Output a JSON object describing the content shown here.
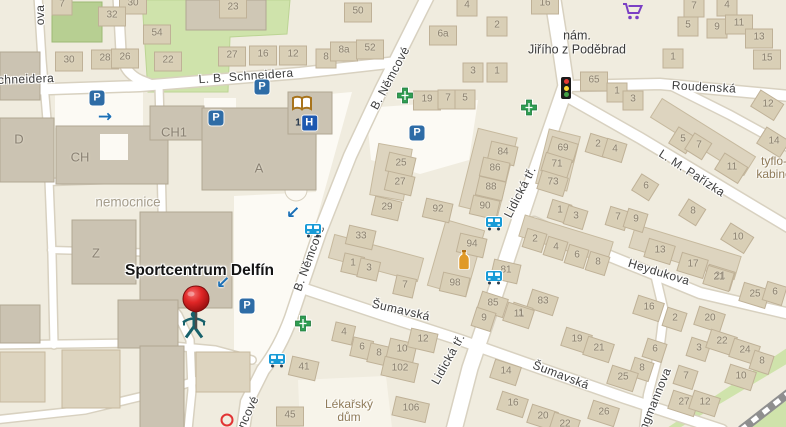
{
  "map": {
    "poi": {
      "label": "Sportcentrum Delfín",
      "x": 196,
      "y": 269
    },
    "street_labels": [
      {
        "text": "ova",
        "x": 40,
        "y": 15,
        "angle": -90
      },
      {
        "text": "chneidera",
        "x": 26,
        "y": 79,
        "angle": -2
      },
      {
        "text": "L. B. Schneidera",
        "x": 246,
        "y": 76,
        "angle": -4
      },
      {
        "text": "B. Němcové",
        "x": 390,
        "y": 78,
        "angle": -62
      },
      {
        "text": "B. Němcové",
        "x": 309,
        "y": 258,
        "angle": -70
      },
      {
        "text": "ncové",
        "x": 248,
        "y": 412,
        "angle": -65
      },
      {
        "text": "Lidická tř.",
        "x": 520,
        "y": 192,
        "angle": -63
      },
      {
        "text": "Lidická tř.",
        "x": 448,
        "y": 359,
        "angle": -61
      },
      {
        "text": "Roudenská",
        "x": 704,
        "y": 87,
        "angle": 3
      },
      {
        "text": "L. M. Pařízka",
        "x": 692,
        "y": 173,
        "angle": 33
      },
      {
        "text": "Heydukova",
        "x": 659,
        "y": 272,
        "angle": 17
      },
      {
        "text": "Šumavská",
        "x": 401,
        "y": 310,
        "angle": 13
      },
      {
        "text": "Šumavská",
        "x": 561,
        "y": 375,
        "angle": 21
      },
      {
        "text": "ngmannova",
        "x": 655,
        "y": 399,
        "angle": -68
      }
    ],
    "area_labels": [
      {
        "lines": [
          "nemocnice"
        ],
        "x": 128,
        "y": 203,
        "style": "style-gray"
      },
      {
        "lines": [
          "nám.",
          "Jiřího z Poděbrad"
        ],
        "x": 577,
        "y": 43,
        "style": "style-dark"
      },
      {
        "lines": [
          "Lékařský",
          "dům"
        ],
        "x": 349,
        "y": 411,
        "style": "style-brown"
      },
      {
        "lines": [
          "tyflo-",
          "kabine"
        ],
        "x": 774,
        "y": 168,
        "style": "style-brown"
      }
    ],
    "building_labels": [
      {
        "text": "D",
        "x": 19,
        "y": 139
      },
      {
        "text": "CH",
        "x": 80,
        "y": 157
      },
      {
        "text": "CH1",
        "x": 174,
        "y": 132
      },
      {
        "text": "A",
        "x": 259,
        "y": 168
      },
      {
        "text": "Z",
        "x": 96,
        "y": 253
      }
    ],
    "house_numbers": [
      [
        "7",
        62,
        4
      ],
      [
        "30",
        133,
        3
      ],
      [
        "32",
        112,
        15
      ],
      [
        "54",
        157,
        33
      ],
      [
        "30",
        69,
        60
      ],
      [
        "28",
        105,
        58
      ],
      [
        "26",
        125,
        57
      ],
      [
        "22",
        168,
        60
      ],
      [
        "23",
        233,
        7
      ],
      [
        "27",
        232,
        55
      ],
      [
        "16",
        263,
        54
      ],
      [
        "12",
        293,
        54
      ],
      [
        "8",
        326,
        57
      ],
      [
        "8a",
        344,
        50
      ],
      [
        "52",
        370,
        48
      ],
      [
        "50",
        358,
        11
      ],
      [
        "6a",
        443,
        34
      ],
      [
        "4",
        467,
        5
      ],
      [
        "2",
        497,
        25
      ],
      [
        "3",
        473,
        71
      ],
      [
        "1",
        497,
        71
      ],
      [
        "19",
        427,
        99
      ],
      [
        "7",
        448,
        98
      ],
      [
        "5",
        465,
        98
      ],
      [
        "16",
        545,
        3
      ],
      [
        "4",
        727,
        5
      ],
      [
        "7",
        694,
        6
      ],
      [
        "5",
        688,
        25
      ],
      [
        "9",
        717,
        27
      ],
      [
        "11",
        739,
        23
      ],
      [
        "13",
        759,
        37
      ],
      [
        "15",
        767,
        58
      ],
      [
        "1",
        673,
        57
      ],
      [
        "65",
        594,
        80
      ],
      [
        "1",
        617,
        91
      ],
      [
        "3",
        633,
        99
      ],
      [
        "12",
        768,
        104
      ],
      [
        "14",
        774,
        141
      ],
      [
        "11",
        732,
        167
      ],
      [
        "69",
        563,
        148
      ],
      [
        "71",
        557,
        164
      ],
      [
        "73",
        553,
        182
      ],
      [
        "2",
        598,
        144
      ],
      [
        "4",
        615,
        149
      ],
      [
        "5",
        683,
        139
      ],
      [
        "7",
        699,
        145
      ],
      [
        "6",
        646,
        186
      ],
      [
        "8",
        693,
        211
      ],
      [
        "10",
        738,
        237
      ],
      [
        "1",
        560,
        210
      ],
      [
        "3",
        576,
        216
      ],
      [
        "7",
        618,
        217
      ],
      [
        "9",
        636,
        219
      ],
      [
        "13",
        660,
        250
      ],
      [
        "17",
        693,
        264
      ],
      [
        "21",
        720,
        276
      ],
      [
        "2",
        535,
        239
      ],
      [
        "4",
        556,
        247
      ],
      [
        "6",
        577,
        255
      ],
      [
        "8",
        598,
        262
      ],
      [
        "25",
        401,
        163
      ],
      [
        "27",
        400,
        182
      ],
      [
        "29",
        387,
        207
      ],
      [
        "33",
        361,
        236
      ],
      [
        "92",
        438,
        209
      ],
      [
        "84",
        503,
        152
      ],
      [
        "86",
        495,
        168
      ],
      [
        "88",
        491,
        187
      ],
      [
        "90",
        485,
        206
      ],
      [
        "94",
        472,
        244
      ],
      [
        "98",
        455,
        283
      ],
      [
        "1",
        353,
        263
      ],
      [
        "3",
        369,
        268
      ],
      [
        "7",
        405,
        285
      ],
      [
        "81",
        506,
        270
      ],
      [
        "85",
        493,
        303
      ],
      [
        "83",
        543,
        301
      ],
      [
        "1",
        521,
        313
      ],
      [
        "19",
        577,
        339
      ],
      [
        "21",
        599,
        348
      ],
      [
        "16",
        649,
        307
      ],
      [
        "2",
        675,
        318
      ],
      [
        "6",
        655,
        349
      ],
      [
        "8",
        642,
        368
      ],
      [
        "25",
        623,
        377
      ],
      [
        "26",
        604,
        412
      ],
      [
        "20",
        543,
        416
      ],
      [
        "22",
        565,
        424
      ],
      [
        "21",
        719,
        277
      ],
      [
        "25",
        755,
        294
      ],
      [
        "6",
        775,
        292
      ],
      [
        "20",
        710,
        318
      ],
      [
        "3",
        699,
        348
      ],
      [
        "22",
        722,
        341
      ],
      [
        "24",
        745,
        350
      ],
      [
        "8",
        762,
        361
      ],
      [
        "10",
        741,
        376
      ],
      [
        "7",
        686,
        376
      ],
      [
        "27",
        684,
        402
      ],
      [
        "12",
        705,
        402
      ],
      [
        "4",
        344,
        332
      ],
      [
        "6",
        362,
        347
      ],
      [
        "8",
        379,
        353
      ],
      [
        "10",
        402,
        349
      ],
      [
        "12",
        423,
        339
      ],
      [
        "102",
        400,
        368
      ],
      [
        "106",
        411,
        408
      ],
      [
        "41",
        304,
        367
      ],
      [
        "45",
        290,
        415
      ],
      [
        "9",
        484,
        318
      ],
      [
        "11",
        519,
        314
      ],
      [
        "14",
        506,
        371
      ],
      [
        "16",
        513,
        403
      ]
    ],
    "icons": [
      {
        "type": "parking",
        "label": "P",
        "x": 97,
        "y": 98
      },
      {
        "type": "parking",
        "label": "P",
        "x": 216,
        "y": 118
      },
      {
        "type": "parking",
        "label": "P",
        "x": 262,
        "y": 87
      },
      {
        "type": "parking",
        "label": "P",
        "x": 417,
        "y": 133
      },
      {
        "type": "parking",
        "label": "P",
        "x": 247,
        "y": 306
      },
      {
        "type": "pharmacy",
        "x": 405,
        "y": 98
      },
      {
        "type": "pharmacy",
        "x": 529,
        "y": 110
      },
      {
        "type": "pharmacy",
        "x": 303,
        "y": 326
      },
      {
        "type": "library",
        "x": 302,
        "y": 106
      },
      {
        "type": "hospital",
        "tag": "1",
        "label": "H",
        "x": 306,
        "y": 123
      },
      {
        "type": "bus-stop",
        "x": 313,
        "y": 233
      },
      {
        "type": "bus-stop",
        "x": 494,
        "y": 226
      },
      {
        "type": "bus-stop",
        "x": 494,
        "y": 280
      },
      {
        "type": "bus-stop",
        "x": 277,
        "y": 363
      },
      {
        "type": "traffic-light",
        "x": 566,
        "y": 88
      },
      {
        "type": "shopping-cart",
        "x": 633,
        "y": 14
      },
      {
        "type": "pub-bottle",
        "x": 464,
        "y": 262
      },
      {
        "type": "swimmer",
        "x": 194,
        "y": 328
      },
      {
        "type": "map-pin",
        "x": 196,
        "y": 334
      },
      {
        "type": "arrow-right",
        "label": "→",
        "x": 105,
        "y": 117
      },
      {
        "type": "arrow-down-left",
        "label": "↙",
        "x": 293,
        "y": 213
      },
      {
        "type": "arrow-down-left",
        "label": "↙",
        "x": 223,
        "y": 283
      },
      {
        "type": "red-circle",
        "x": 227,
        "y": 420
      }
    ],
    "colors": {
      "map_bg": "#f0ecdf",
      "road_white": "#ffffff",
      "road_casing": "#d8d1c0",
      "building_gray": "#cbc3b2",
      "building_tan": "#ddd4bf",
      "building_small": "#d9cfb6",
      "park_green": "#cfe3ab",
      "pin_red": "#d32424",
      "parking_blue": "#2e6ca6",
      "pharmacy_green": "#2f9e53",
      "hospital_blue": "#1d58b0",
      "bus_blue": "#189bd7",
      "cart_purple": "#7b3fc4",
      "bottle_orange": "#e09a28",
      "arrow_blue": "#1a6fb5"
    }
  }
}
